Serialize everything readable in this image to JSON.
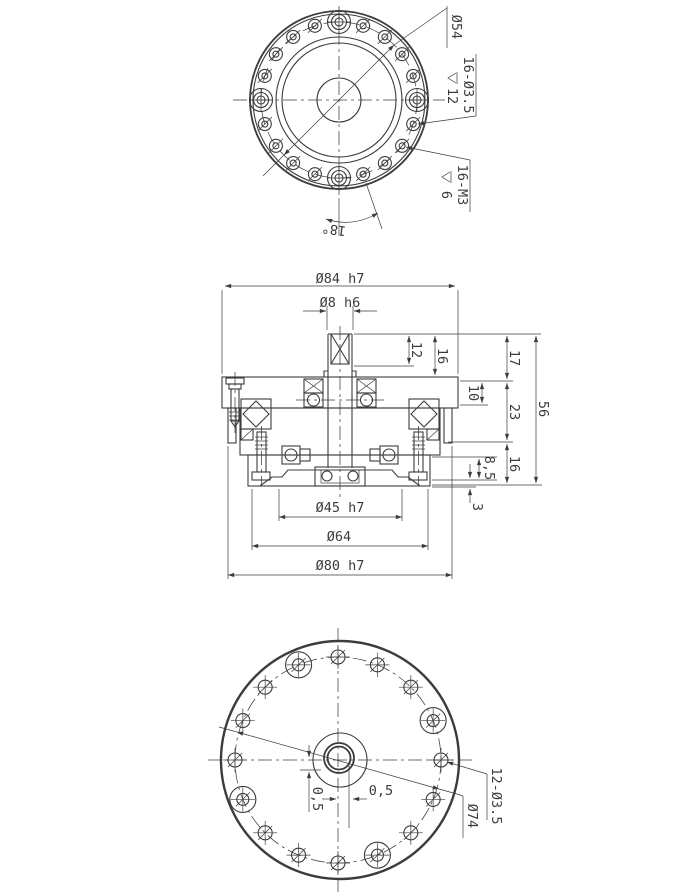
{
  "colors": {
    "line": "#3c3c3c",
    "bg": "#ffffff"
  },
  "top_view": {
    "dia54": "Ø54",
    "drill_note": "16-Ø3.5",
    "drill_depth": "12",
    "tap_note": "16-M3",
    "tap_depth": "6",
    "angle": "18°",
    "pattern": {
      "step_deg": 18,
      "large_deg": [
        0,
        90,
        180,
        270
      ],
      "pitch_r": 78,
      "center": [
        339,
        100
      ]
    }
  },
  "section_view": {
    "dia84": "Ø84 h7",
    "dia8": "Ø8 h6",
    "d12": "12",
    "d16_top": "16",
    "d17": "17",
    "d10": "10",
    "d23": "23",
    "d56": "56",
    "d16_low": "16",
    "d8_5": "8,5",
    "d3": "3",
    "dia45": "Ø45 h7",
    "dia64": "Ø64",
    "dia80": "Ø80 h7"
  },
  "bottom_view": {
    "off_h": "0,5",
    "off_v": "0,5",
    "holes_note": "12-Ø3.5",
    "dia74": "Ø74",
    "pattern": {
      "step_deg": 22.5,
      "large_deg": [
        22.5,
        112.5,
        202.5,
        292.5
      ],
      "pitch_r": 103,
      "center": [
        338,
        760
      ]
    }
  }
}
